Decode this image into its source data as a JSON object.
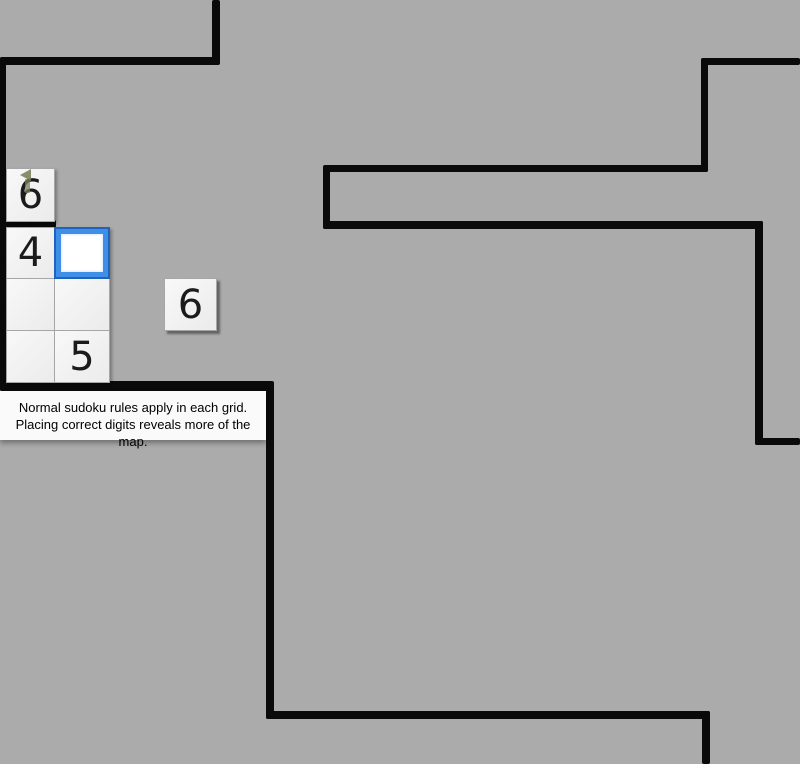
{
  "game": {
    "cells": {
      "top": "6",
      "r1c1": "4",
      "r1c2": "",
      "r2c1": "",
      "r2c2": "",
      "r3c1": "",
      "r3c2": "5",
      "floating": "6"
    },
    "selected_cell": "r1c2",
    "marker_icon": "player-arrow-marker",
    "hint_tooltip": {
      "line1": "Normal sudoku rules apply in each grid.",
      "line2": "Placing correct digits reveals more of the map."
    }
  },
  "colors": {
    "background": "#ababab",
    "wall": "#0a0a0a",
    "cell_fill": "#f1f1f1",
    "cell_border": "#a6a6a6",
    "digit": "#1b1b1b",
    "selected_outline": "#1e63bc",
    "selected_border": "#3f8fe8",
    "selected_fill": "#ffffff",
    "marker": "#79805a",
    "tooltip_bg": "#fafafa",
    "tooltip_text": "#000000"
  }
}
